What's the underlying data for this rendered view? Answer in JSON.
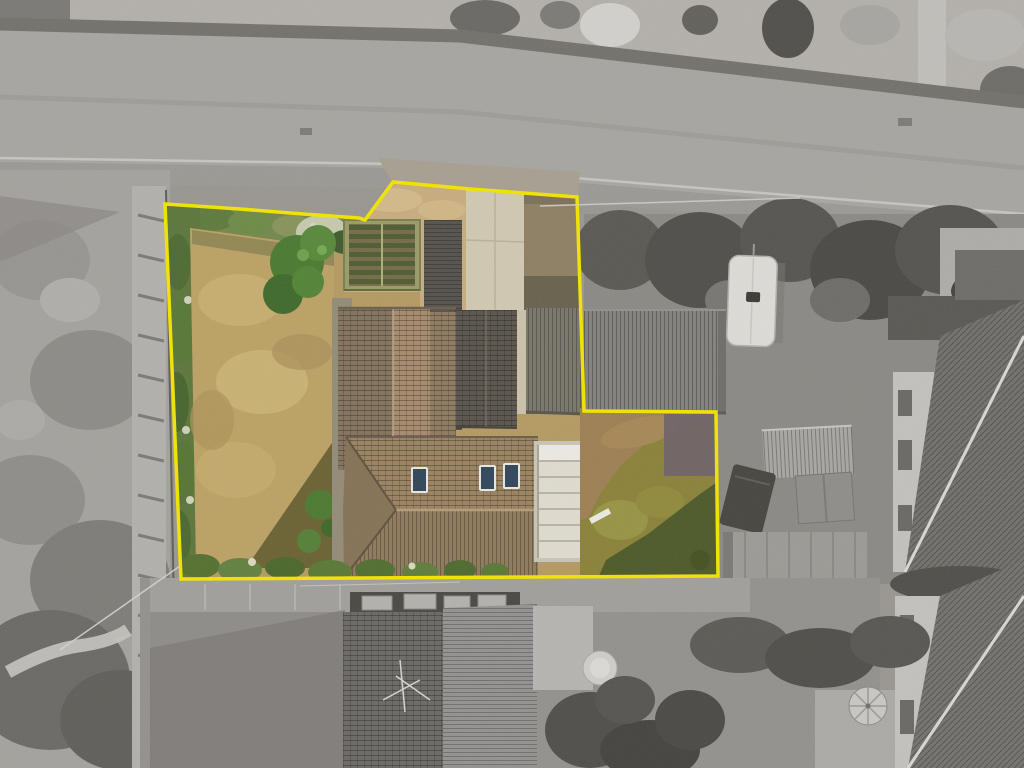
{
  "scene": {
    "type": "aerial-property-photo",
    "description": "Overhead drone photograph of a residential plot outlined in yellow; the plot interior is in colour while all surrounding land, road and neighbouring houses are desaturated to greyscale."
  },
  "colors": {
    "boundary": "#F2E400",
    "background_gray": "#999691",
    "road": "#A7A5A0",
    "road_wall": "#73716B",
    "plot_base": "#B49A62",
    "lawn_dry": "#BBA164",
    "hedge_green": "#5C763B",
    "tree_green": "#4A7A30",
    "gravel_tan": "#C7AC7E",
    "concrete": "#D0C8B2",
    "drive_brown": "#8E7F63",
    "roof_brown": "#9A8260",
    "roof_brown_light": "#A68A6C",
    "roof_brown_dark": "#83725D",
    "roof_dark_gray": "#59544B",
    "greenhouse_frame": "#9A9A68",
    "greenhouse_slat_green": "#4E5C31",
    "greenhouse_slat_brown": "#756B49",
    "conservatory_white": "#DFDBCF",
    "garden_olive": "#8A8139",
    "garden_dry_brown": "#9D7F53",
    "garden_shadow_green": "#4D5929",
    "caravan_white": "#DDDBD6",
    "skylight_blue": "#31465A",
    "neighbour_roof_gray": "#72706B",
    "neighbour_wall_gray": "#C3C1BC"
  },
  "objects": {
    "plot_boundary": "yellow property boundary outline",
    "road": "road running along the top of the image",
    "left_lawn": "large rear lawn of dried grass",
    "left_hedge": "hedge along west boundary",
    "flower_bed": "shrub and blossom bed at top of lawn",
    "trees": "garden trees",
    "greenhouse": "greenhouse with slatted roof",
    "gravel_drive": "gravel driveway at plot entrance",
    "concrete_pad": "concrete hardstanding",
    "main_house": "main house with brown tiled hip roof and three roof windows",
    "extension": "dark grey tiled extension",
    "conservatory": "white-roofed conservatory",
    "right_garden": "side garden of olive and dry grass",
    "garage": "long corrugated garage roof",
    "caravan": "white caravan parked on neighbouring land",
    "neighbour_house_bottom": "neighbouring house below the plot",
    "neighbour_houses_right": "neighbouring houses at right edge",
    "parasol": "garden parasol",
    "paddock": "rough grass paddock on the left"
  }
}
